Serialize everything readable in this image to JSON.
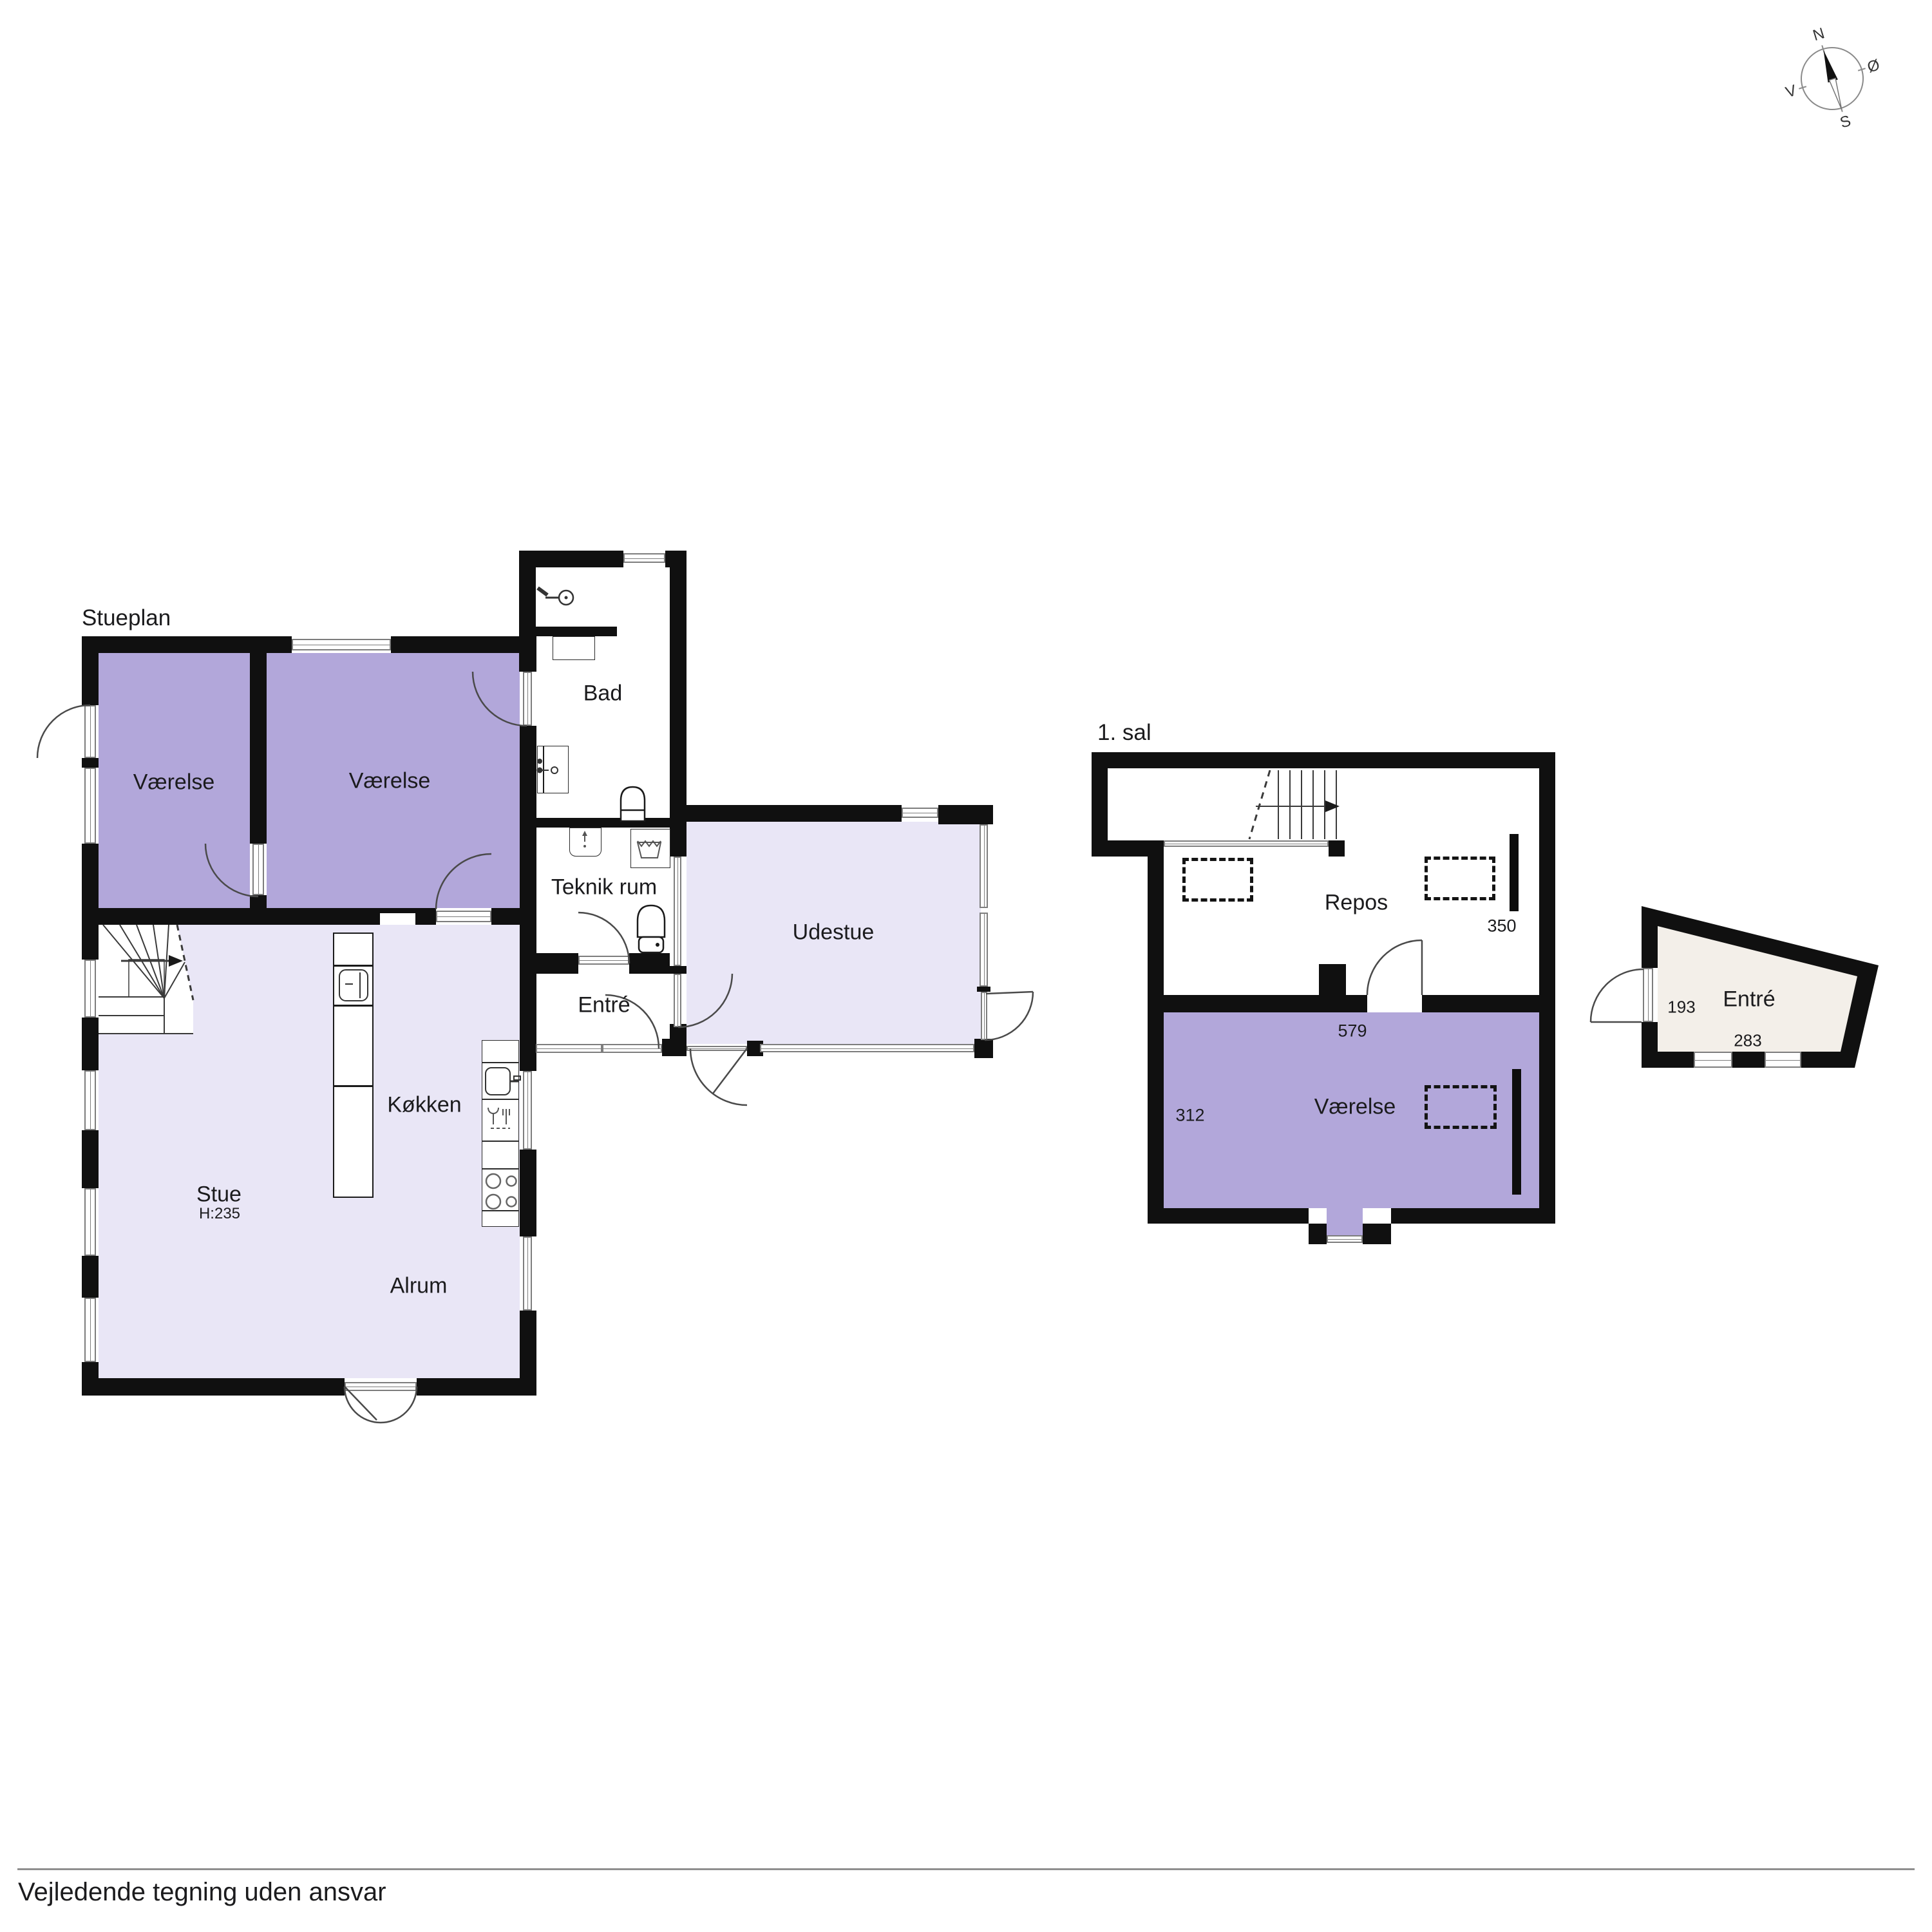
{
  "page": {
    "footer": "Vejledende tegning uden ansvar"
  },
  "colors": {
    "room_purple": "#b2a7da",
    "room_lavender": "#e9e6f6",
    "annex_beige": "#f3efe9",
    "wall": "#101010"
  },
  "compass": {
    "n": "N",
    "e": "Ø",
    "s": "S",
    "w": "V"
  },
  "ground_floor": {
    "title": "Stueplan",
    "rooms": {
      "vaerelse_left": {
        "label": "Værelse"
      },
      "vaerelse_right": {
        "label": "Værelse"
      },
      "bad": {
        "label": "Bad"
      },
      "teknik": {
        "label": "Teknik rum"
      },
      "entre": {
        "label": "Entré"
      },
      "udestue": {
        "label": "Udestue"
      },
      "koekken": {
        "label": "Køkken"
      },
      "stue": {
        "label": "Stue",
        "height": "H:235"
      },
      "alrum": {
        "label": "Alrum"
      }
    }
  },
  "first_floor": {
    "title": "1. sal",
    "rooms": {
      "repos": {
        "label": "Repos",
        "dim": "350"
      },
      "vaerelse": {
        "label": "Værelse",
        "dim_width": "579",
        "dim_side": "312"
      }
    }
  },
  "annex": {
    "entre": {
      "label": "Entré",
      "dim_side": "193",
      "dim_width": "283"
    }
  }
}
